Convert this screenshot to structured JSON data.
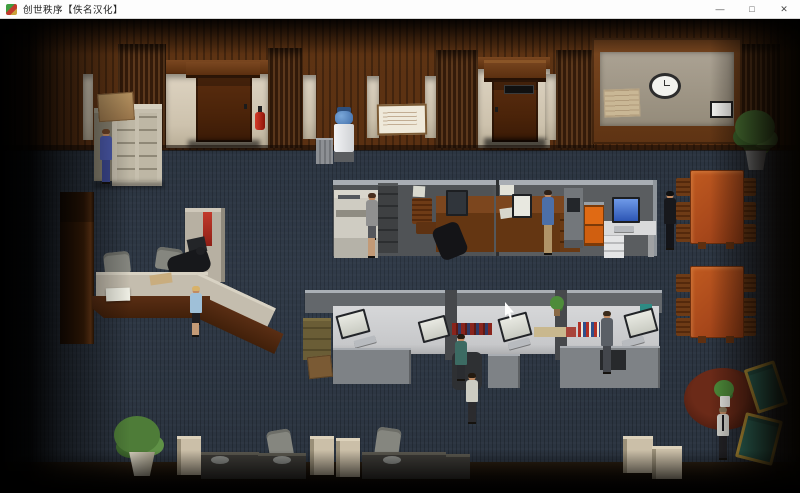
{
  "window": {
    "title": "创世秩序【佚名汉化】",
    "icon": "game-icon",
    "controls": {
      "minimize": "—",
      "maximize": "□",
      "close": "✕"
    }
  },
  "scene": {
    "type": "isometric office interior (point-and-click game view)",
    "colors": {
      "carpet": "#2b3440",
      "wood_wall": "#5a3012",
      "cream_wall": "#cdc2ad",
      "door": "#4a2309",
      "partition": "#55585b",
      "white_desk": "#d3d4d6",
      "wood_desk": "#6e3c16",
      "conference_table": "#a8481b",
      "orange_cabinet": "#e06a14",
      "teal_armchair": "#2f6f60",
      "armchair_frame": "#c9a23c",
      "rug": "#5a2316",
      "monitor_screen_blue": "#3f6fd0",
      "fire_extinguisher": "#c01818"
    },
    "objects": [
      "wood-paneled-wall",
      "office-door-left",
      "office-door-right",
      "fire-extinguisher",
      "filing-cabinet",
      "cardboard-box",
      "water-cooler",
      "trash-can",
      "notice-board",
      "wall-map",
      "wall-clock",
      "framed-sign",
      "wall-plant",
      "reception-desk",
      "office-chairs",
      "copier",
      "upper-cubicle-row",
      "lower-cubicle-row",
      "monitors",
      "keyboards",
      "kiosk-terminal",
      "orange-cabinet",
      "white-desk",
      "conference-table-1",
      "conference-table-2",
      "wooden-chairs",
      "carrel-row",
      "floor-plant",
      "round-rug",
      "rug-plant",
      "teal-armchairs"
    ],
    "people": [
      {
        "id": "man-blue-suit",
        "activity": "standing at filing cabinets"
      },
      {
        "id": "blonde-woman",
        "activity": "standing in front of reception desk"
      },
      {
        "id": "receptionist-dark",
        "activity": "seated behind reception desk"
      },
      {
        "id": "woman-at-copier",
        "activity": "using the copier"
      },
      {
        "id": "man-seated-upper",
        "activity": "seated at upper cubicle desk"
      },
      {
        "id": "man-blue-shirt",
        "activity": "standing at upper cubicle desk"
      },
      {
        "id": "man-in-black",
        "activity": "standing near conference tables"
      },
      {
        "id": "man-seated-teal",
        "activity": "seated at lower cubicle"
      },
      {
        "id": "man-gray-suit",
        "activity": "standing in lower cubicle row"
      },
      {
        "id": "man-walking",
        "activity": "walking across the floor"
      },
      {
        "id": "man-white-shirt-tie",
        "activity": "standing on the round rug"
      }
    ],
    "cursor": {
      "x": 505,
      "y": 302
    }
  }
}
